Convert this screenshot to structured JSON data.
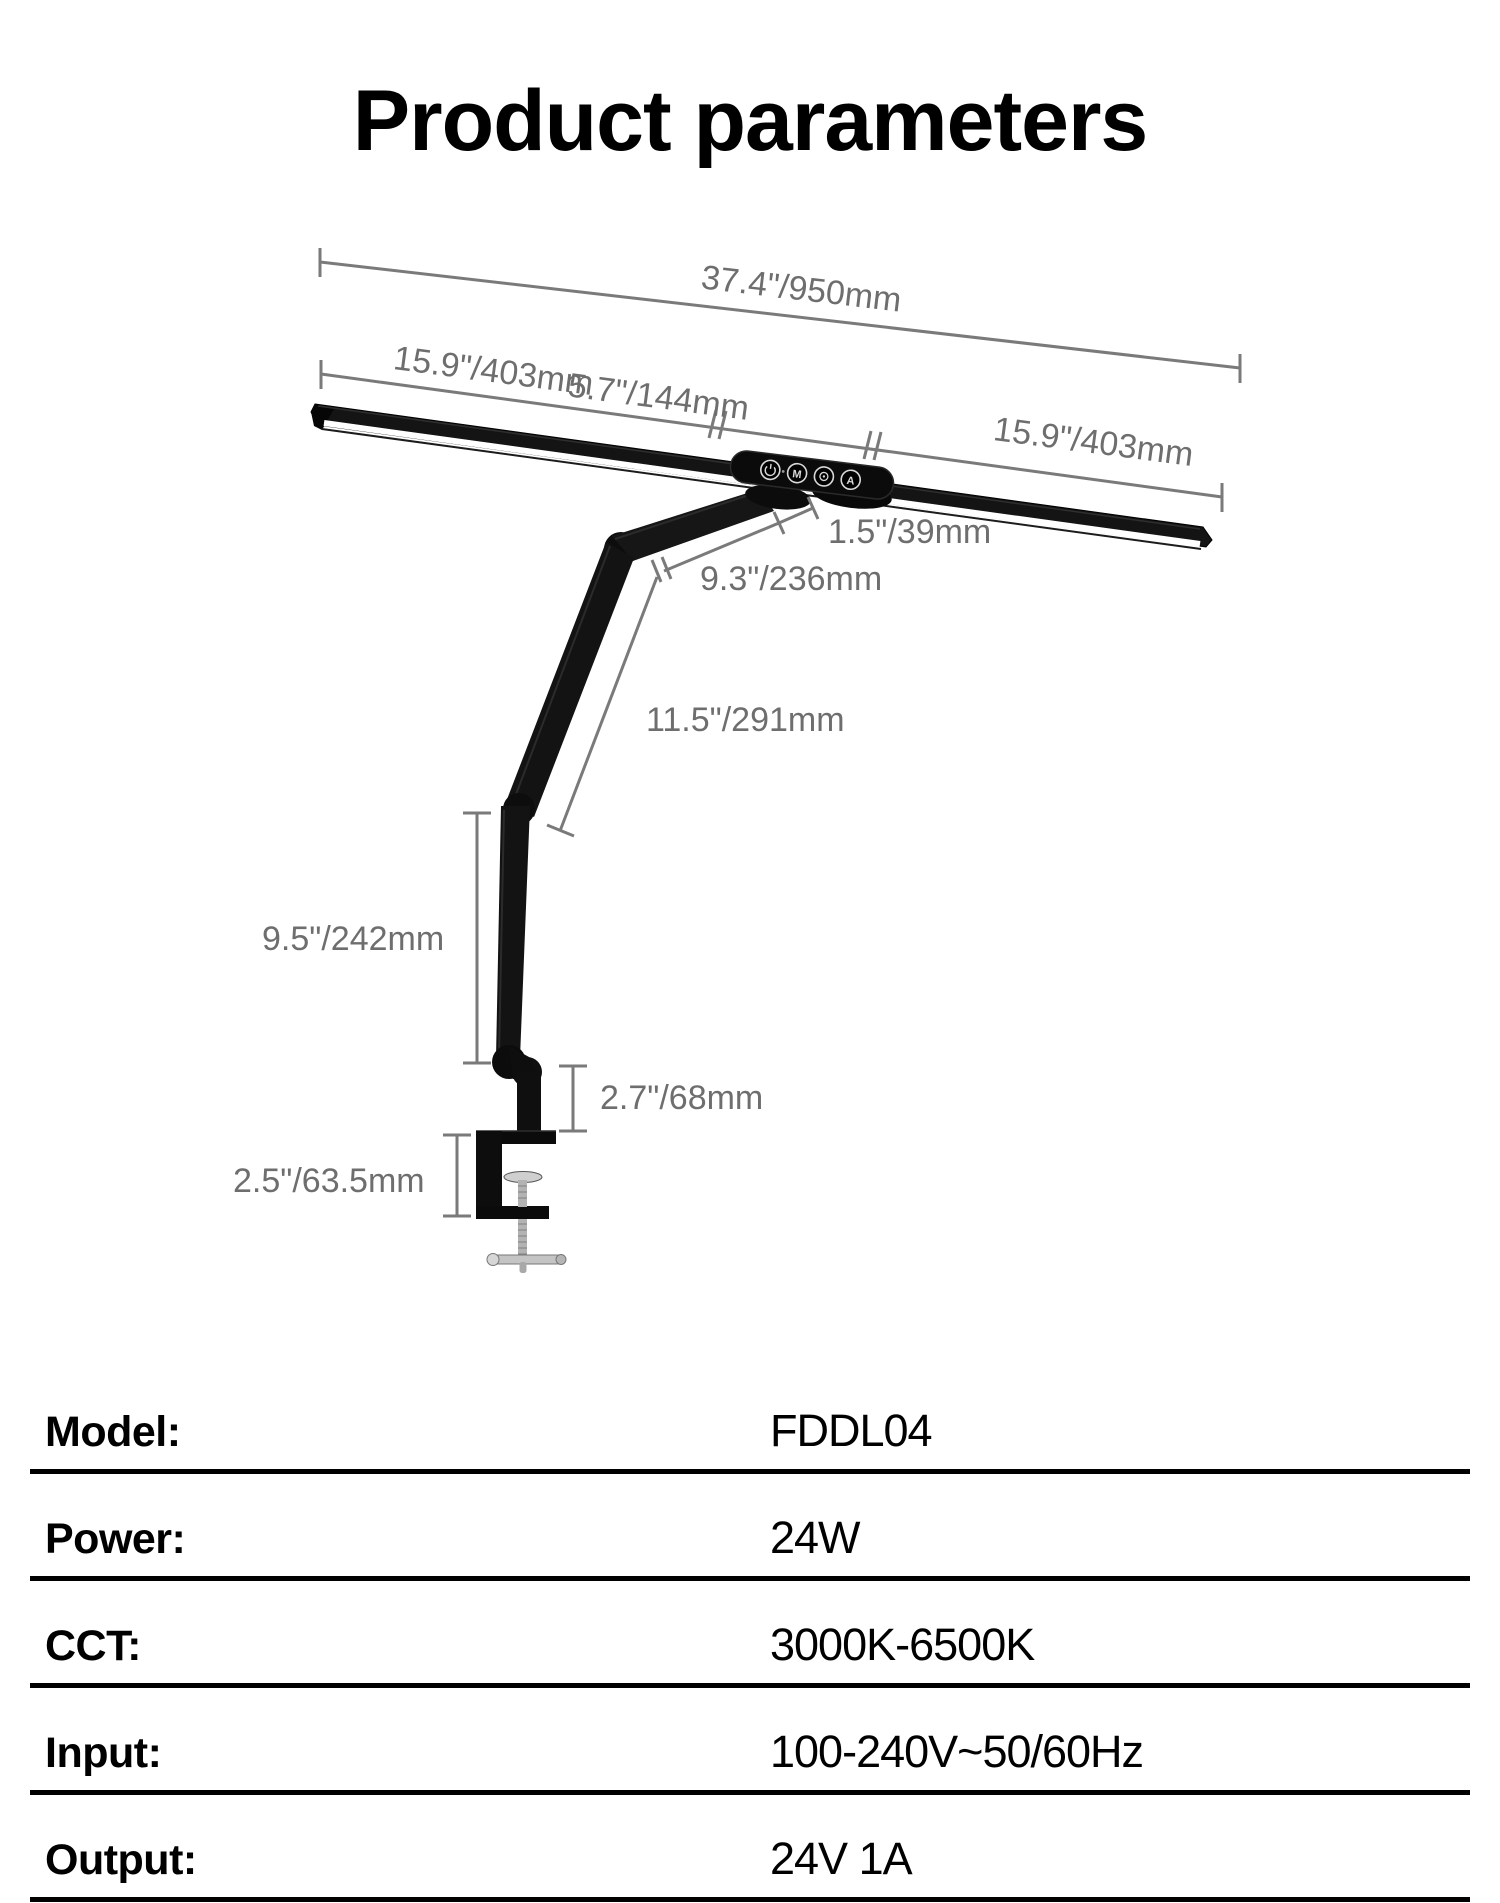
{
  "title": "Product parameters",
  "colors": {
    "dim_line": "#7a7a7a",
    "dim_text": "#6e6e6e",
    "lamp_black": "#121212",
    "divider": "#000000"
  },
  "diagram": {
    "dimensions": {
      "overall_width": "37.4\"/950mm",
      "left_bar": "15.9\"/403mm",
      "center_section": "5.7\"/144mm",
      "right_bar": "15.9\"/403mm",
      "head_offset": "1.5\"/39mm",
      "head_arm": "9.3\"/236mm",
      "upper_arm": "11.5\"/291mm",
      "lower_arm": "9.5\"/242mm",
      "riser_post": "2.7\"/68mm",
      "clamp_opening": "2.5\"/63.5mm"
    },
    "buttons": [
      {
        "glyph": "power",
        "label": "power-button"
      },
      {
        "glyph": "M",
        "label": "mode-button"
      },
      {
        "glyph": "brightness",
        "label": "brightness-button"
      },
      {
        "glyph": "A",
        "label": "auto-button"
      }
    ]
  },
  "table": {
    "rows": [
      {
        "label": "Model:",
        "value": "FDDL04"
      },
      {
        "label": "Power:",
        "value": "24W"
      },
      {
        "label": "CCT:",
        "value": "3000K-6500K"
      },
      {
        "label": "Input:",
        "value": "100-240V~50/60Hz"
      },
      {
        "label": "Output:",
        "value": "24V 1A"
      }
    ]
  }
}
